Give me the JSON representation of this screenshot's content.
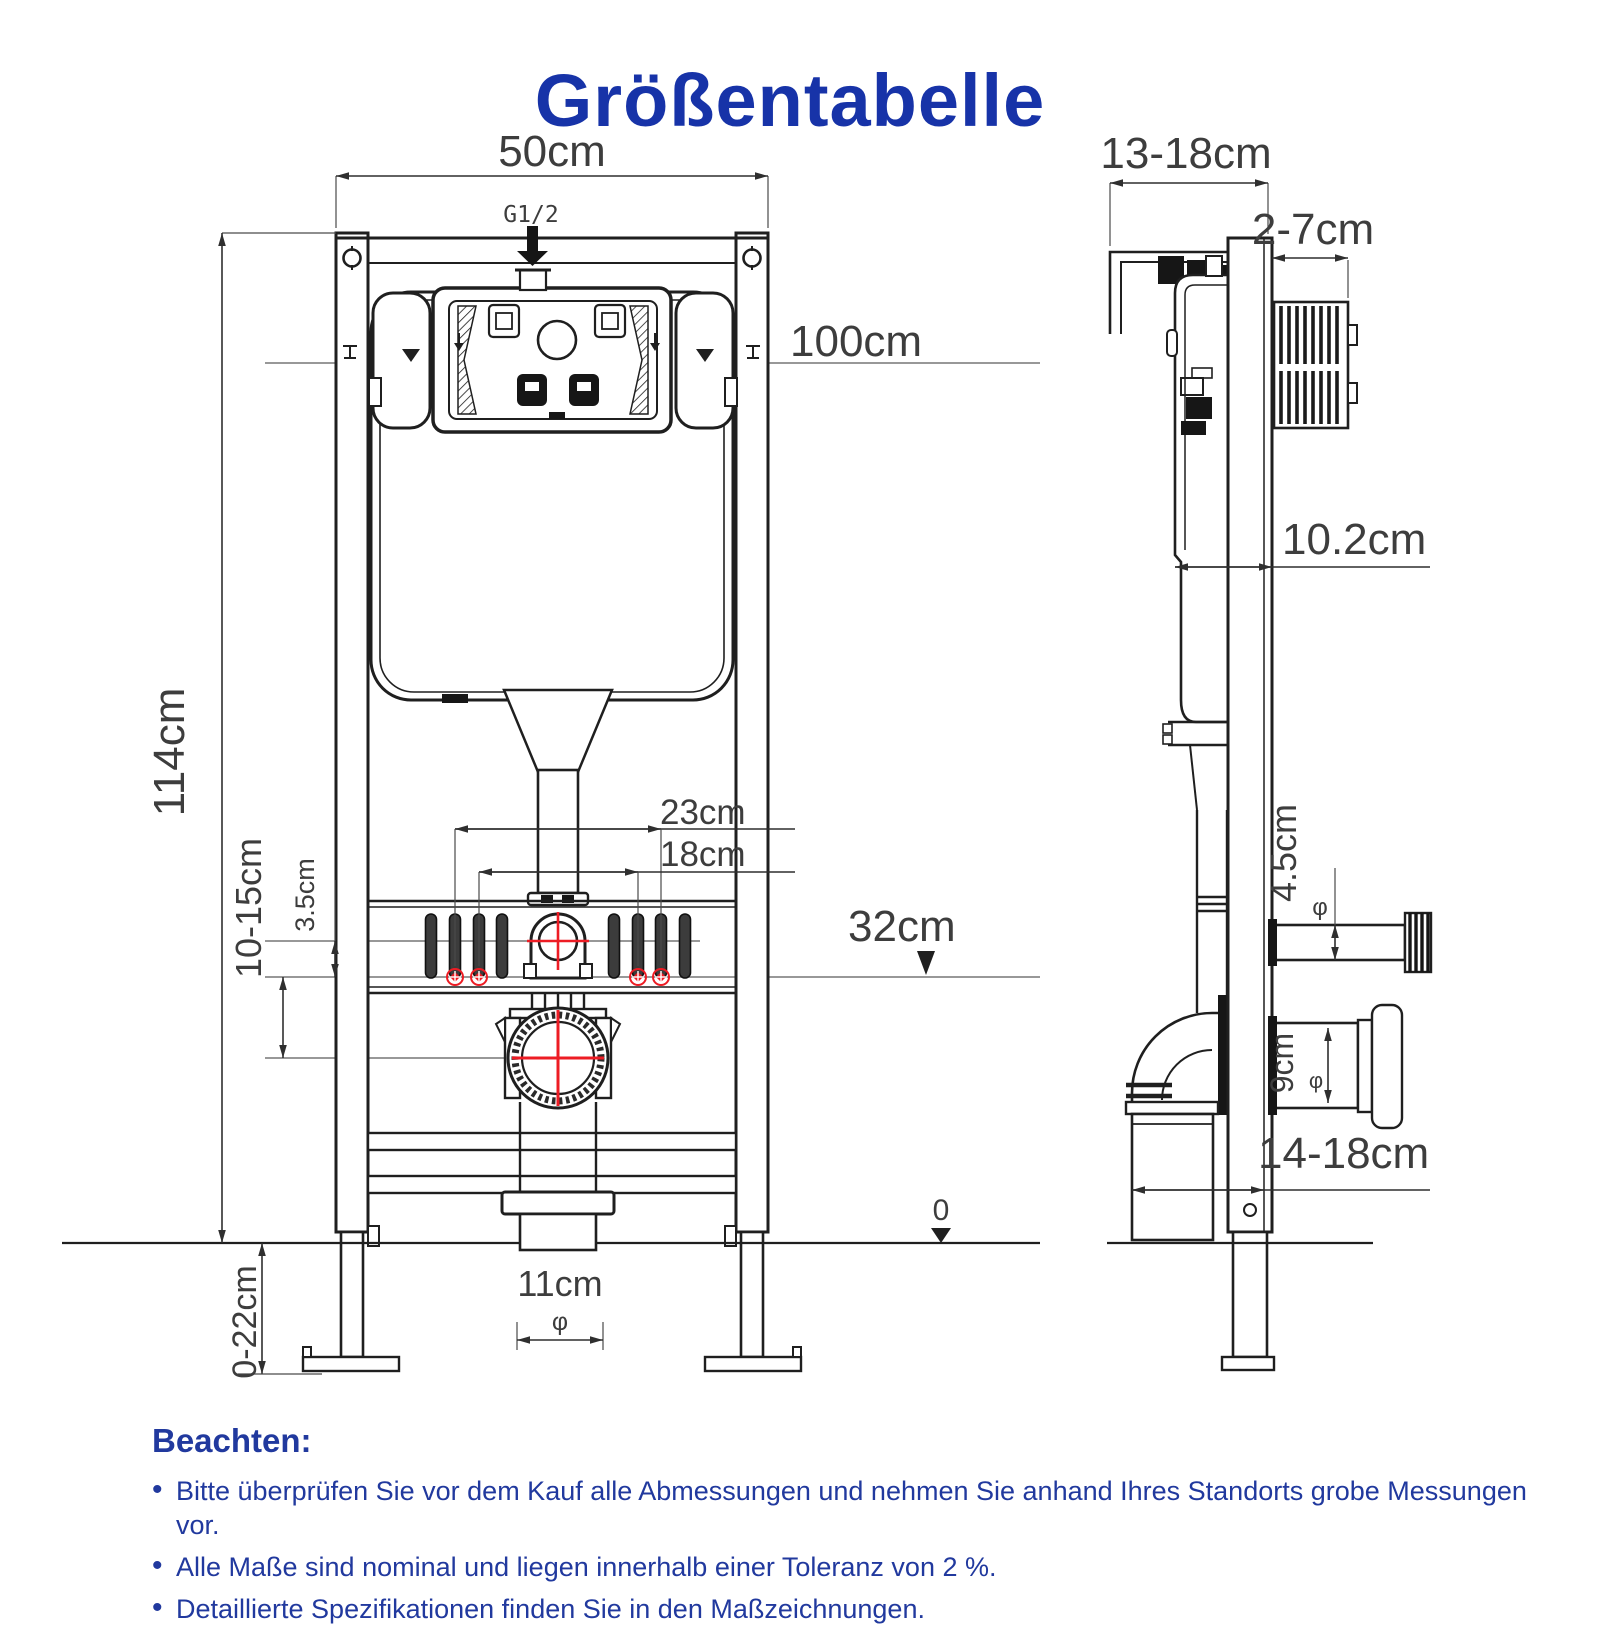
{
  "title": "Größentabelle",
  "colors": {
    "title_blue": "#1733a8",
    "notes_blue": "#21399e",
    "dimension_red": "#ed1c24",
    "line_black": "#1f1f1f"
  },
  "diameter_symbol": "φ",
  "front_view": {
    "frame_width": "50cm",
    "water_inlet_thread": "G1/2",
    "flush_plate_height": "100cm",
    "frame_height": "114cm",
    "anchor_spacing_outer": "23cm",
    "anchor_spacing_inner": "18cm",
    "anchor_offset": "3.5cm",
    "outlet_center_range": "10-15cm",
    "outlet_height": "32cm",
    "floor_level": "0",
    "drain_diameter": "11cm",
    "leg_adjust_range": "0-22cm"
  },
  "side_view": {
    "frame_depth": "13-18cm",
    "plate_recess": "2-7cm",
    "cistern_depth": "10.2cm",
    "inlet_pipe_diameter": "4.5cm",
    "drain_pipe_diameter": "9cm",
    "outlet_depth": "14-18cm"
  },
  "notes": {
    "heading": "Beachten:",
    "items": [
      "Bitte überprüfen Sie vor dem Kauf alle Abmessungen und nehmen Sie anhand Ihres Standorts grobe Messungen vor.",
      "Alle Maße sind nominal und liegen innerhalb einer Toleranz von 2 %.",
      "Detaillierte Spezifikationen finden Sie in den Maßzeichnungen."
    ]
  }
}
